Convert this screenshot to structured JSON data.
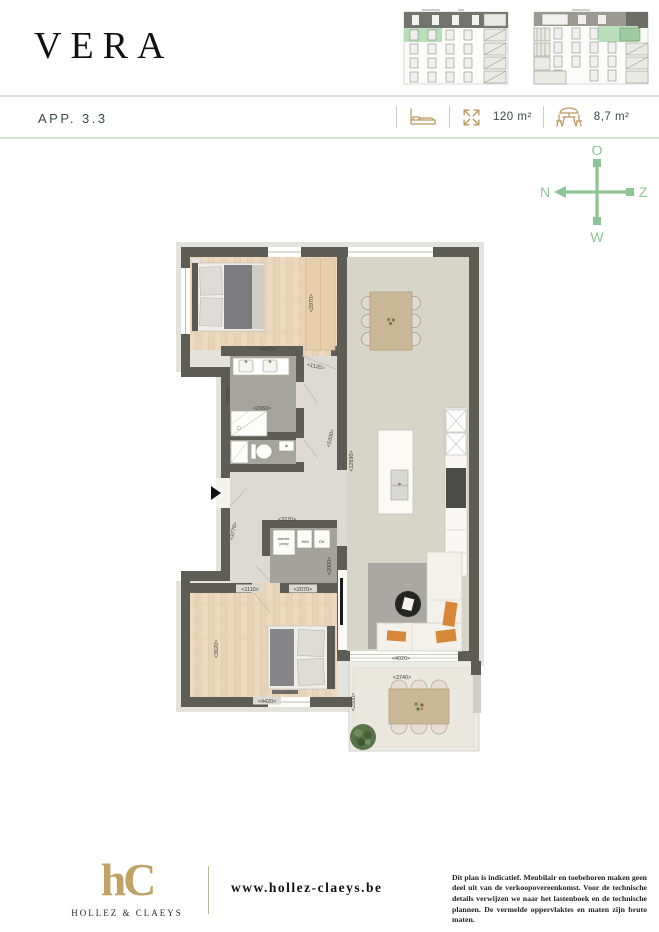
{
  "header": {
    "title": "VERA",
    "app": "APP. 3.3",
    "area": "120 m²",
    "terrace_area": "8,7 m²"
  },
  "compass": {
    "top": "O",
    "left": "N",
    "right": "Z",
    "bottom": "W"
  },
  "plan": {
    "dimensions": [
      {
        "t": "<4420>",
        "x": 267,
        "y": 349
      },
      {
        "t": "<2970>",
        "x": 311,
        "y": 303,
        "r": -90
      },
      {
        "t": "<1120>",
        "x": 316,
        "y": 366,
        "r": 12
      },
      {
        "t": "<2540>",
        "x": 228,
        "y": 395,
        "r": -90
      },
      {
        "t": "<2060>",
        "x": 262,
        "y": 408
      },
      {
        "t": "<5300>",
        "x": 330,
        "y": 438,
        "r": -78
      },
      {
        "t": "<12690>",
        "x": 351,
        "y": 461,
        "r": -90
      },
      {
        "t": "<3270>",
        "x": 287,
        "y": 519
      },
      {
        "t": "<2000>",
        "x": 329,
        "y": 566,
        "r": -90
      },
      {
        "t": "<3770>",
        "x": 233,
        "y": 531,
        "r": -78
      },
      {
        "t": "<1110>",
        "x": 250,
        "y": 589,
        "plate": true
      },
      {
        "t": "<2070>",
        "x": 303,
        "y": 589,
        "plate": true
      },
      {
        "t": "<3620>",
        "x": 216,
        "y": 649,
        "r": -90
      },
      {
        "t": "<4420>",
        "x": 267,
        "y": 701,
        "plate": true
      },
      {
        "t": "<4020>",
        "x": 401,
        "y": 658
      },
      {
        "t": "<3740>",
        "x": 402,
        "y": 677
      },
      {
        "t": "<2500>",
        "x": 353,
        "y": 702,
        "r": -90
      }
    ],
    "room_labels": [
      {
        "t": "warmte-",
        "x": 284,
        "y": 538,
        "s": 3.6
      },
      {
        "t": "pomp",
        "x": 284,
        "y": 543,
        "s": 3.6
      },
      {
        "t": "WM",
        "x": 305,
        "y": 541,
        "s": 4
      },
      {
        "t": "DK",
        "x": 322,
        "y": 541,
        "s": 4
      }
    ]
  },
  "footer": {
    "logo": "hC",
    "brand": "HOLLEZ & CLAEYS",
    "website": "www.hollez-claeys.be",
    "disclaimer": "Dit plan is indicatief. Meubilair en toebehoren maken geen deel uit van de verkoopovereenkomst. Voor de technische details verwijzen we naar het lastenboek en de technische plannen. De vermelde oppervlaktes en maten zijn bruto maten."
  },
  "colors": {
    "gold": "#b99a5f",
    "green": "#8cc593",
    "band_border": "#d6e4d4",
    "highlight_green": "#b8dfba",
    "wall": "#5d5d56",
    "wood_floor": "#ecd9bf",
    "living_floor": "#d7d4c8",
    "accent_orange": "#d6873a"
  }
}
